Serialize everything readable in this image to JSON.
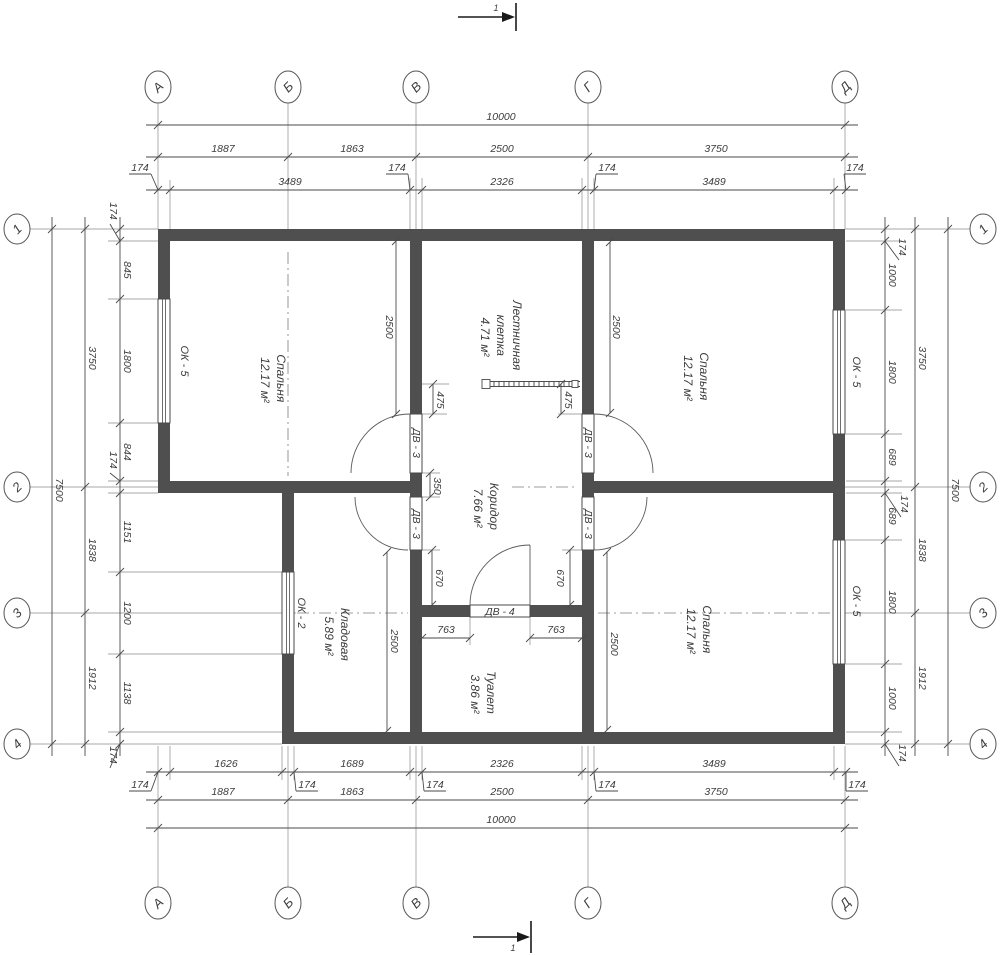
{
  "drawing": {
    "section_label": "1",
    "axes": {
      "cols": [
        "А",
        "Б",
        "В",
        "Г",
        "Д"
      ],
      "col_x": [
        158,
        288,
        416,
        588,
        845
      ],
      "rows": [
        "1",
        "2",
        "3",
        "4"
      ],
      "row_y": [
        229,
        487,
        613,
        744
      ]
    },
    "rooms": [
      {
        "name": "Спальня",
        "area": "12.17 м²"
      },
      {
        "name": "Лестничная",
        "name2": "клетка",
        "area": "4.71 м²"
      },
      {
        "name": "Коридор",
        "area": "7.66 м²"
      },
      {
        "name": "Спальня",
        "area": "12.17 м²"
      },
      {
        "name": "Кладовая",
        "area": "5.89 м²"
      },
      {
        "name": "Туалет",
        "area": "3.86 м²"
      },
      {
        "name": "Спальня",
        "area": "12.17 м²"
      }
    ],
    "windows": [
      "ОК - 5",
      "ОК - 5",
      "ОК - 5",
      "ОК - 2"
    ],
    "doors": [
      "ДВ - 3",
      "ДВ - 3",
      "ДВ - 3",
      "ДВ - 3",
      "ДВ - 4"
    ],
    "dim_chains": [
      {
        "o": "h",
        "line": 125,
        "s": 146,
        "e": 858,
        "ticks": [
          158,
          845
        ],
        "labels": [
          {
            "t": "10000",
            "p": 501
          }
        ]
      },
      {
        "o": "h",
        "line": 157,
        "s": 146,
        "e": 858,
        "ticks": [
          158,
          288,
          416,
          588,
          845
        ],
        "labels": [
          {
            "t": "1887",
            "p": 223
          },
          {
            "t": "1863",
            "p": 352
          },
          {
            "t": "2500",
            "p": 502
          },
          {
            "t": "3750",
            "p": 716
          }
        ]
      },
      {
        "o": "h",
        "line": 190,
        "s": 146,
        "e": 858,
        "ticks": [
          158,
          170,
          410,
          422,
          582,
          594,
          834,
          846
        ],
        "labels": [
          {
            "t": "3489",
            "p": 290
          },
          {
            "t": "2326",
            "p": 502
          },
          {
            "t": "3489",
            "p": 714
          }
        ],
        "leaders": [
          {
            "t": "174",
            "tx": 158,
            "lx": 140,
            "ly": 171
          },
          {
            "t": "174",
            "tx": 410,
            "lx": 397,
            "ly": 171
          },
          {
            "t": "174",
            "tx": 594,
            "lx": 607,
            "ly": 171
          },
          {
            "t": "174",
            "tx": 846,
            "lx": 855,
            "ly": 171
          }
        ]
      },
      {
        "o": "h",
        "line": 772,
        "s": 146,
        "e": 858,
        "ticks": [
          158,
          170,
          282,
          294,
          410,
          422,
          582,
          594,
          834,
          846
        ],
        "labels": [
          {
            "t": "1626",
            "p": 226
          },
          {
            "t": "1689",
            "p": 352
          },
          {
            "t": "2326",
            "p": 502
          },
          {
            "t": "3489",
            "p": 714
          }
        ],
        "leaders": [
          {
            "t": "174",
            "tx": 158,
            "lx": 140,
            "ly": 788
          },
          {
            "t": "174",
            "tx": 294,
            "lx": 307,
            "ly": 788
          },
          {
            "t": "174",
            "tx": 422,
            "lx": 435,
            "ly": 788
          },
          {
            "t": "174",
            "tx": 594,
            "lx": 607,
            "ly": 788
          },
          {
            "t": "174",
            "tx": 846,
            "lx": 857,
            "ly": 788
          }
        ]
      },
      {
        "o": "h",
        "line": 800,
        "s": 146,
        "e": 858,
        "ticks": [
          158,
          288,
          416,
          588,
          845
        ],
        "labels": [
          {
            "t": "1887",
            "p": 223
          },
          {
            "t": "1863",
            "p": 352
          },
          {
            "t": "2500",
            "p": 502
          },
          {
            "t": "3750",
            "p": 716
          }
        ]
      },
      {
        "o": "h",
        "line": 828,
        "s": 146,
        "e": 858,
        "ticks": [
          158,
          845
        ],
        "labels": [
          {
            "t": "10000",
            "p": 501
          }
        ]
      },
      {
        "o": "v",
        "line": 120,
        "s": 217,
        "e": 756,
        "ticks": [
          229,
          241,
          299,
          423,
          481,
          493,
          572,
          654,
          732,
          744
        ],
        "labels": [
          {
            "t": "845",
            "p": 270
          },
          {
            "t": "1800",
            "p": 361
          },
          {
            "t": "844",
            "p": 452
          },
          {
            "t": "1151",
            "p": 532
          },
          {
            "t": "1200",
            "p": 613
          },
          {
            "t": "1138",
            "p": 693
          }
        ],
        "leaders": [
          {
            "t": "174",
            "tx": 241,
            "lx": 110,
            "ly": 211
          },
          {
            "t": "174",
            "tx": 481,
            "lx": 110,
            "ly": 460
          },
          {
            "t": "174",
            "tx": 744,
            "lx": 110,
            "ly": 755
          }
        ]
      },
      {
        "o": "v",
        "line": 85,
        "s": 217,
        "e": 756,
        "ticks": [
          229,
          487,
          613,
          744
        ],
        "labels": [
          {
            "t": "3750",
            "p": 358
          },
          {
            "t": "1838",
            "p": 550
          },
          {
            "t": "1912",
            "p": 678
          }
        ]
      },
      {
        "o": "v",
        "line": 52,
        "s": 217,
        "e": 756,
        "ticks": [
          229,
          744
        ],
        "labels": [
          {
            "t": "7500",
            "p": 490
          }
        ]
      },
      {
        "o": "v",
        "line": 885,
        "s": 217,
        "e": 756,
        "ticks": [
          229,
          241,
          310,
          434,
          481,
          493,
          540,
          664,
          732,
          744
        ],
        "labels": [
          {
            "t": "1000",
            "p": 275
          },
          {
            "t": "1800",
            "p": 372
          },
          {
            "t": "689",
            "p": 457
          },
          {
            "t": "689",
            "p": 516
          },
          {
            "t": "1800",
            "p": 602
          },
          {
            "t": "1000",
            "p": 698
          }
        ],
        "leaders": [
          {
            "t": "174",
            "tx": 241,
            "lx": 899,
            "ly": 247
          },
          {
            "t": "174",
            "tx": 493,
            "lx": 901,
            "ly": 504
          },
          {
            "t": "174",
            "tx": 744,
            "lx": 899,
            "ly": 753
          }
        ]
      },
      {
        "o": "v",
        "line": 915,
        "s": 217,
        "e": 756,
        "ticks": [
          229,
          487,
          613,
          744
        ],
        "labels": [
          {
            "t": "3750",
            "p": 358
          },
          {
            "t": "1838",
            "p": 550
          },
          {
            "t": "1912",
            "p": 678
          }
        ]
      },
      {
        "o": "v",
        "line": 948,
        "s": 217,
        "e": 756,
        "ticks": [
          229,
          744
        ],
        "labels": [
          {
            "t": "7500",
            "p": 490
          }
        ]
      }
    ],
    "free_dims": [
      {
        "o": "v",
        "line": 396,
        "s": 241,
        "e": 414,
        "t": "2500",
        "lx": 386,
        "ly": 327
      },
      {
        "o": "v",
        "line": 610,
        "s": 242,
        "e": 413,
        "t": "2500",
        "lx": 613,
        "ly": 327
      },
      {
        "o": "v",
        "line": 430,
        "s": 473,
        "e": 497,
        "t": "350",
        "lx": 434,
        "ly": 486
      },
      {
        "o": "v",
        "line": 433,
        "s": 384,
        "e": 414,
        "t": "475",
        "lx": 437,
        "ly": 400
      },
      {
        "o": "v",
        "line": 561,
        "s": 384,
        "e": 414,
        "t": "475",
        "lx": 565,
        "ly": 400
      },
      {
        "o": "v",
        "line": 432,
        "s": 550,
        "e": 605,
        "t": "670",
        "lx": 436,
        "ly": 578
      },
      {
        "o": "v",
        "line": 570,
        "s": 550,
        "e": 605,
        "t": "670",
        "lx": 557,
        "ly": 578
      },
      {
        "o": "h",
        "line": 638,
        "s": 422,
        "e": 470,
        "t": "763",
        "lx": 446,
        "ly": 633
      },
      {
        "o": "h",
        "line": 638,
        "s": 530,
        "e": 582,
        "t": "763",
        "lx": 556,
        "ly": 633
      },
      {
        "o": "v",
        "line": 387,
        "s": 552,
        "e": 731,
        "t": "2500",
        "lx": 391,
        "ly": 641
      },
      {
        "o": "v",
        "line": 607,
        "s": 552,
        "e": 730,
        "t": "2500",
        "lx": 611,
        "ly": 644
      }
    ]
  }
}
